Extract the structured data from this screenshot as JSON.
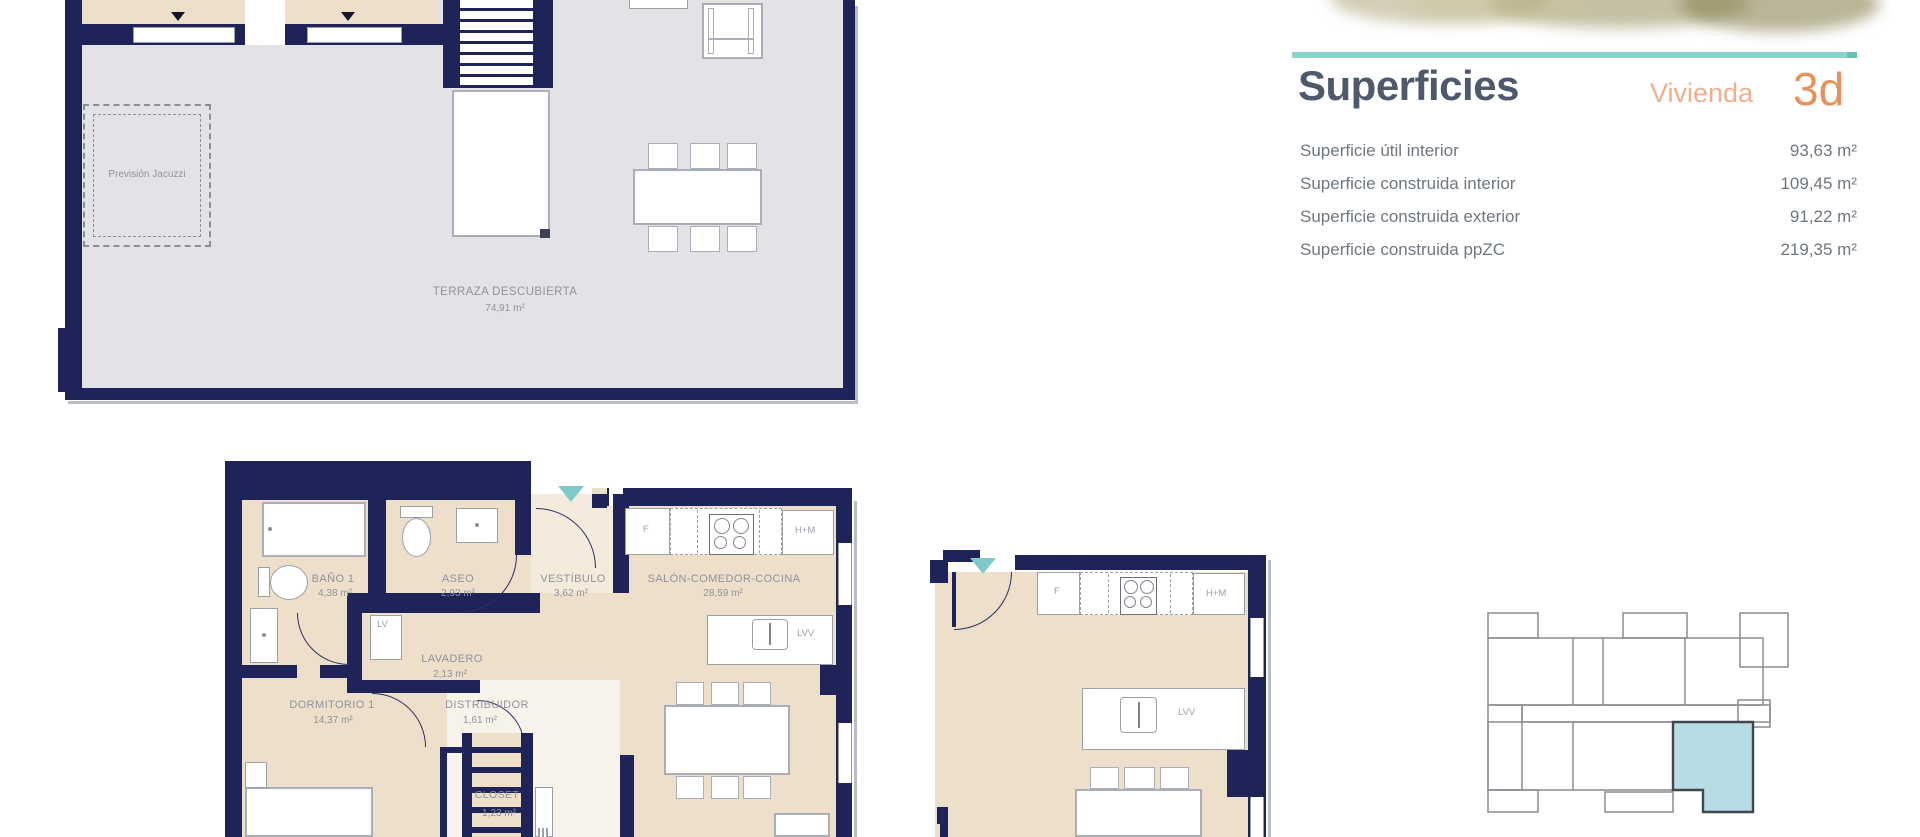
{
  "panel": {
    "title": "Superficies",
    "vivienda_label": "Vivienda",
    "unit": "3d",
    "rows": [
      {
        "label": "Superficie útil interior",
        "value": "93,63 m²"
      },
      {
        "label": "Superficie construida interior",
        "value": "109,45 m²"
      },
      {
        "label": "Superficie construida exterior",
        "value": "91,22 m²"
      },
      {
        "label": "Superficie construida ppZC",
        "value": "219,35 m²"
      }
    ],
    "accent_teal": "#8ed1cd",
    "title_color": "#4e5a6b",
    "vivienda_color": "#efae8c",
    "unit_color": "#e6925d"
  },
  "terrace": {
    "label": "TERRAZA DESCUBIERTA",
    "area": "74,91 m²",
    "jacuzzi": "Previsión Jacuzzi"
  },
  "apartment": {
    "rooms": {
      "banio": {
        "name": "BAÑO 1",
        "area": "4,38 m²"
      },
      "aseo": {
        "name": "ASEO",
        "area": "2,93 m²"
      },
      "vestibulo": {
        "name": "VESTÍBULO",
        "area": "3,62 m²"
      },
      "salon": {
        "name": "SALÓN-COMEDOR-COCINA",
        "area": "28,59 m²"
      },
      "lavadero": {
        "name": "LAVADERO",
        "area": "2,13 m²"
      },
      "dormitorio": {
        "name": "DORMITORIO 1",
        "area": "14,37 m²"
      },
      "distribuidor": {
        "name": "DISTRIBUIDOR",
        "area": "1,61 m²"
      },
      "closet": {
        "name": "CLOSET",
        "area": "1,23 m²"
      }
    },
    "kitchen": {
      "f": "F",
      "hm": "H+M",
      "lv": "LV",
      "lvv": "LVV"
    }
  },
  "colors": {
    "wall_navy": "#1e2458",
    "terrace_floor": "#e3e3e7",
    "room_beige": "#eddfc9",
    "key_unit_teal": "#b7dce3"
  }
}
